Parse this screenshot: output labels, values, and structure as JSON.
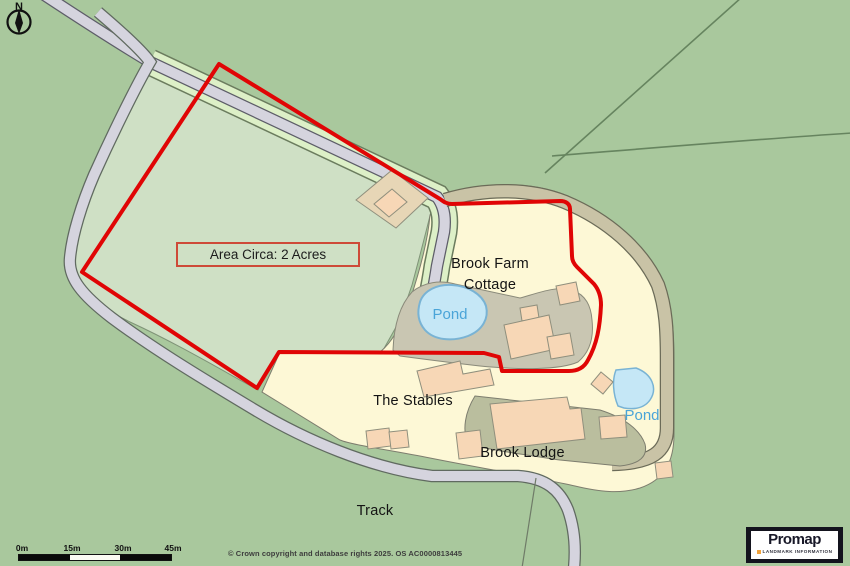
{
  "colors": {
    "boundary_red": "#E00505",
    "terrain_green": "#A9C89D",
    "enclosed_field_green": "#CFE0C5",
    "property_grounds_yellow": "#FDF8D6",
    "building_peach": "#F7D7B6",
    "building_plot_tan": "#E7D6B6",
    "pond_blue": "#C5E7F6",
    "pond_label_blue": "#4AA4D8",
    "road_grey": "#D5D4DE",
    "verge_green": "#DDF0C7",
    "driveway_tan": "#C9C3A6",
    "cottage_yard_grey": "#C9C6B2",
    "lodge_yard_olive": "#BABE9E",
    "promap_navy": "#13131D",
    "promap_orange": "#F2A33C"
  },
  "north_indicator": {
    "label": "N"
  },
  "annotations": {
    "area_box": "Area Circa: 2 Acres"
  },
  "labels": {
    "brook_farm_cottage": {
      "line1": "Brook Farm",
      "line2": "Cottage"
    },
    "pond_west": "Pond",
    "pond_east": "Pond",
    "the_stables": "The Stables",
    "brook_lodge": "Brook Lodge",
    "track": "Track"
  },
  "scale_bar": {
    "ticks": [
      "0m",
      "15m",
      "30m",
      "45m"
    ]
  },
  "footer": {
    "copyright": "© Crown copyright and database rights 2025. OS AC0000813445"
  },
  "branding": {
    "name": "Promap",
    "tagline": "LANDMARK INFORMATION"
  }
}
